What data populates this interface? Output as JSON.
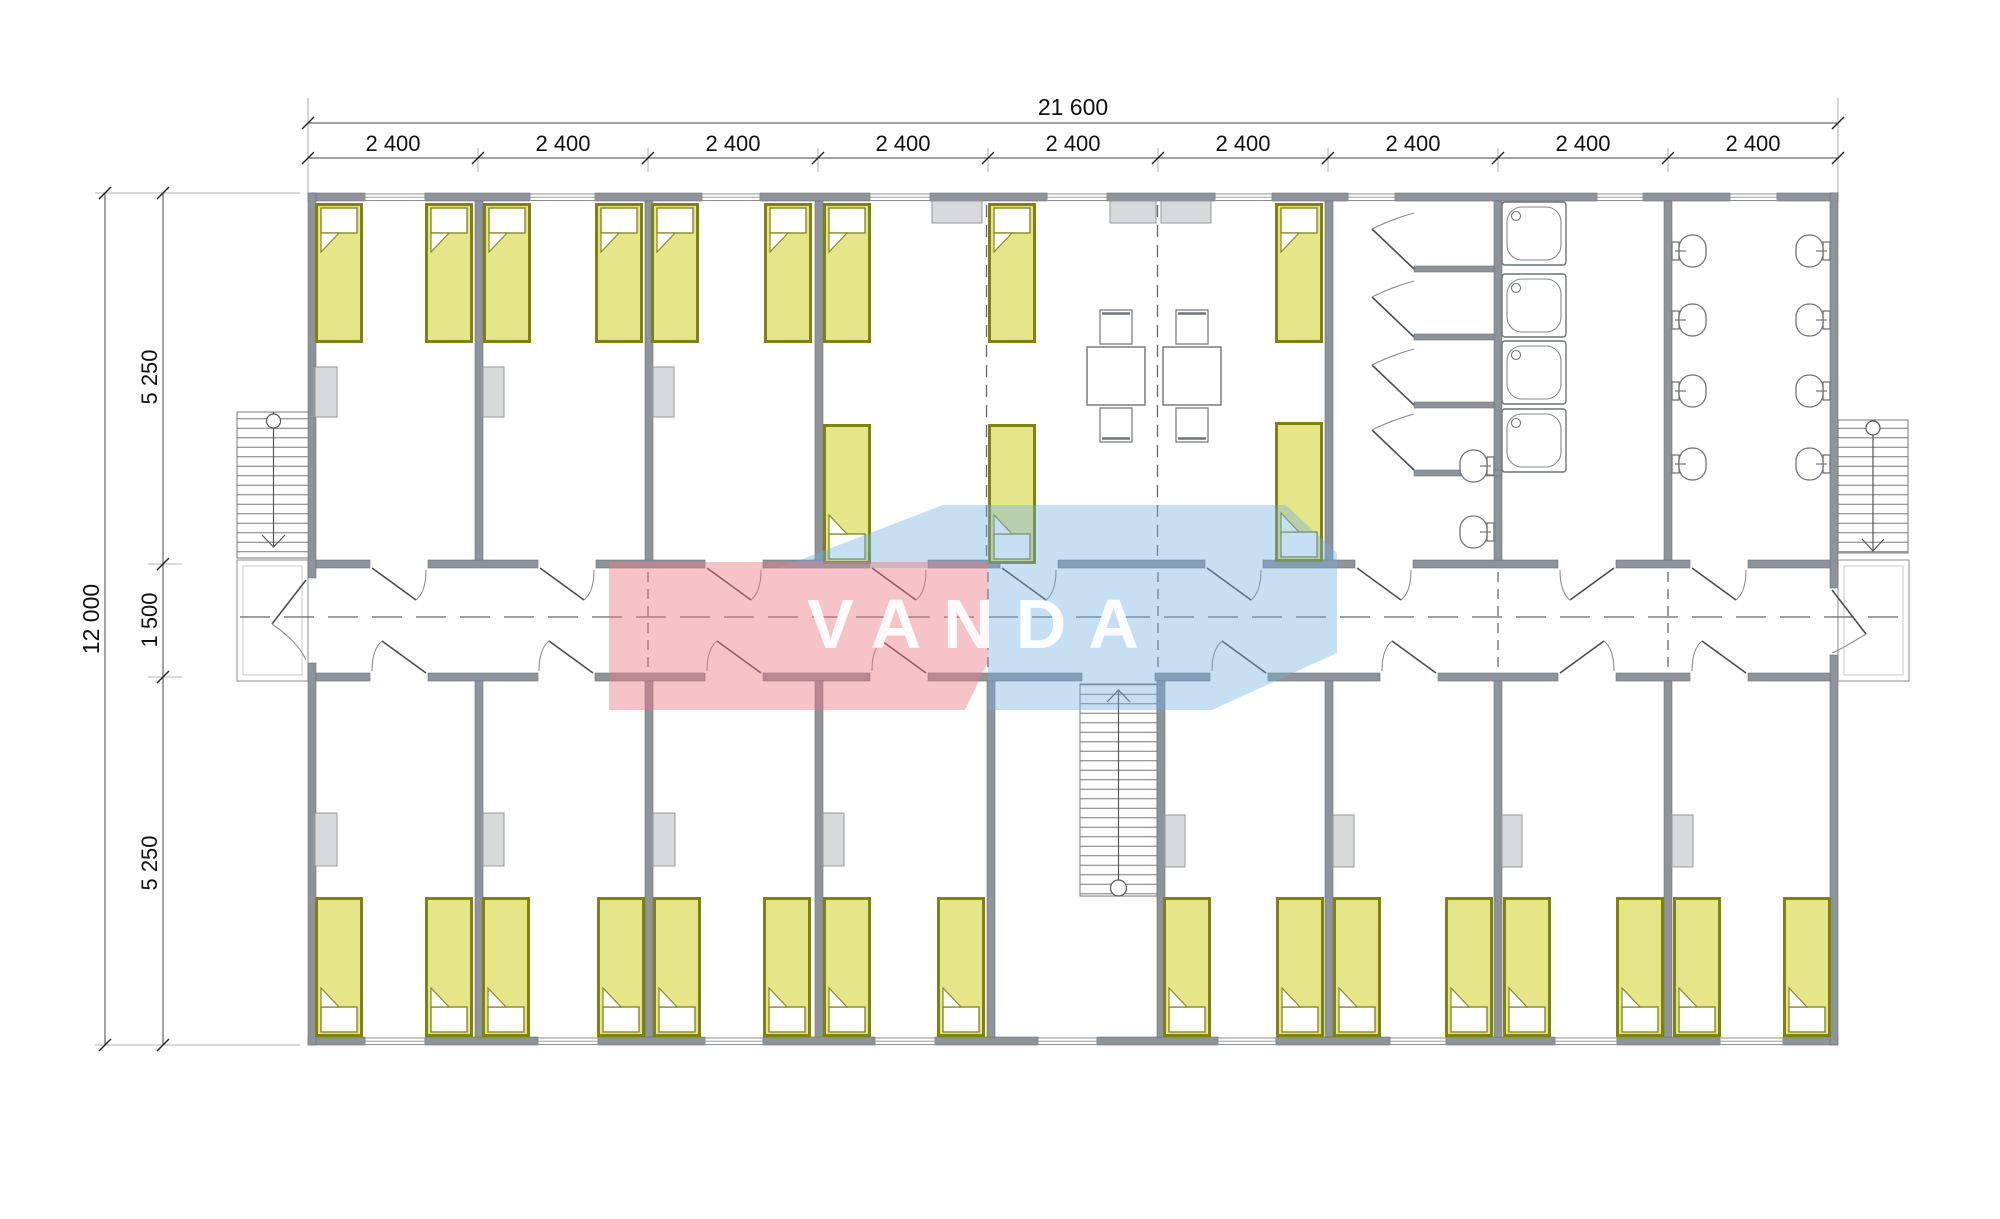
{
  "drawing": {
    "title": "Dormitory floor plan",
    "kind": "architectural-floor-plan"
  },
  "watermark": {
    "text": "VANDA",
    "pink_color": "#EC7A85",
    "blue_color": "#74AEE0"
  },
  "dimensions": {
    "total_width_label": "21 600",
    "top_segment_labels": [
      "2 400",
      "2 400",
      "2 400",
      "2 400",
      "2 400",
      "2 400",
      "2 400",
      "2 400",
      "2 400"
    ],
    "total_height_label": "12 000",
    "left_segment_labels": [
      "5 250",
      "1 500",
      "5 250"
    ]
  },
  "inventory": {
    "bedrooms_top": 3,
    "bedrooms_bottom": 8,
    "common_room_modules": 3,
    "beds_total": 28,
    "wardrobes": 11,
    "wall_cabinets": 3,
    "dining_tables": 2,
    "chairs": 4,
    "shower_trays": 4,
    "shower_stall_doors": 4,
    "toilets": 8,
    "wash_basins": 2,
    "external_staircases": 2,
    "internal_staircases": 1
  },
  "colors": {
    "wall": "#8F939A",
    "bed_fill": "#E5E688",
    "bed_border": "#7E830F",
    "furniture": "#D8D9DA",
    "lines": "#555555"
  }
}
